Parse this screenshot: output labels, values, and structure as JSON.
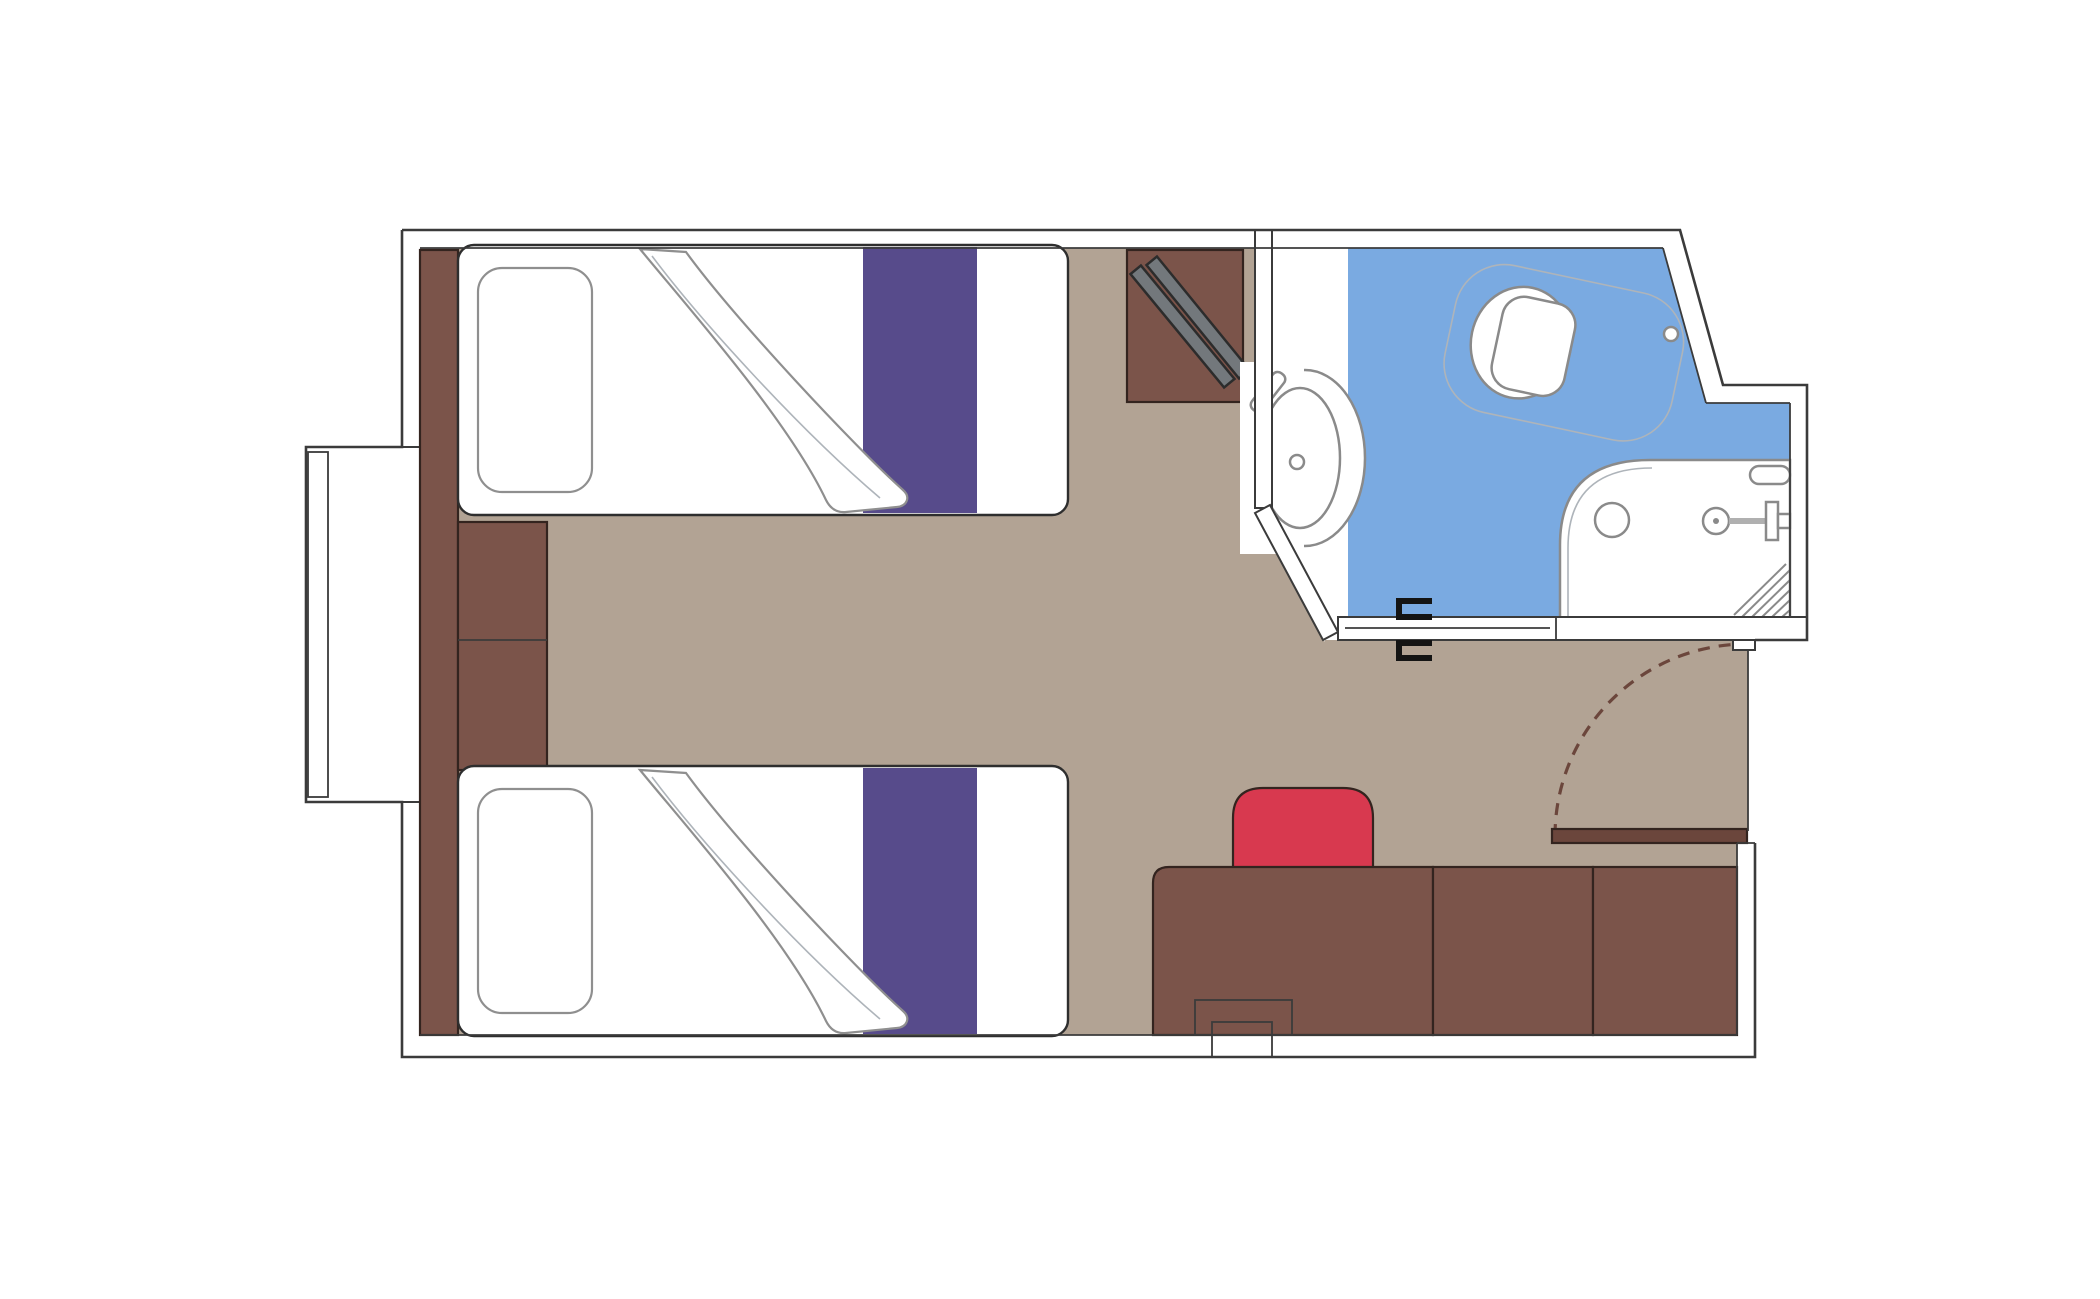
{
  "meta": {
    "type": "floor-plan",
    "subject": "cruise-cabin-with-two-twin-beds-and-bathroom"
  },
  "colors": {
    "background": "#ffffff",
    "wall_line": "#3b3b3b",
    "floor_taupe": "#b2a394",
    "furniture_brown": "#7b544a",
    "door_leaf_brown": "#6b463c",
    "bed_runner_purple": "#574b8b",
    "chair_red": "#d8394f",
    "bathroom_floor_blue": "#7aaae1",
    "window_glass_blue": "#dce8f6",
    "ladder_gray": "#73787c",
    "fixture_gray": "#8a8a8a",
    "white": "#ffffff"
  },
  "elements": {
    "rooms": [
      "cabin",
      "bathroom"
    ],
    "furniture": [
      "twin-bed-upper",
      "twin-bed-lower",
      "pillow",
      "folded-blanket",
      "headboard-panel",
      "nightstand",
      "wardrobe",
      "desk",
      "chair",
      "window",
      "entrance-door"
    ],
    "bathroom_fixtures": [
      "sink",
      "toilet",
      "shower"
    ]
  }
}
